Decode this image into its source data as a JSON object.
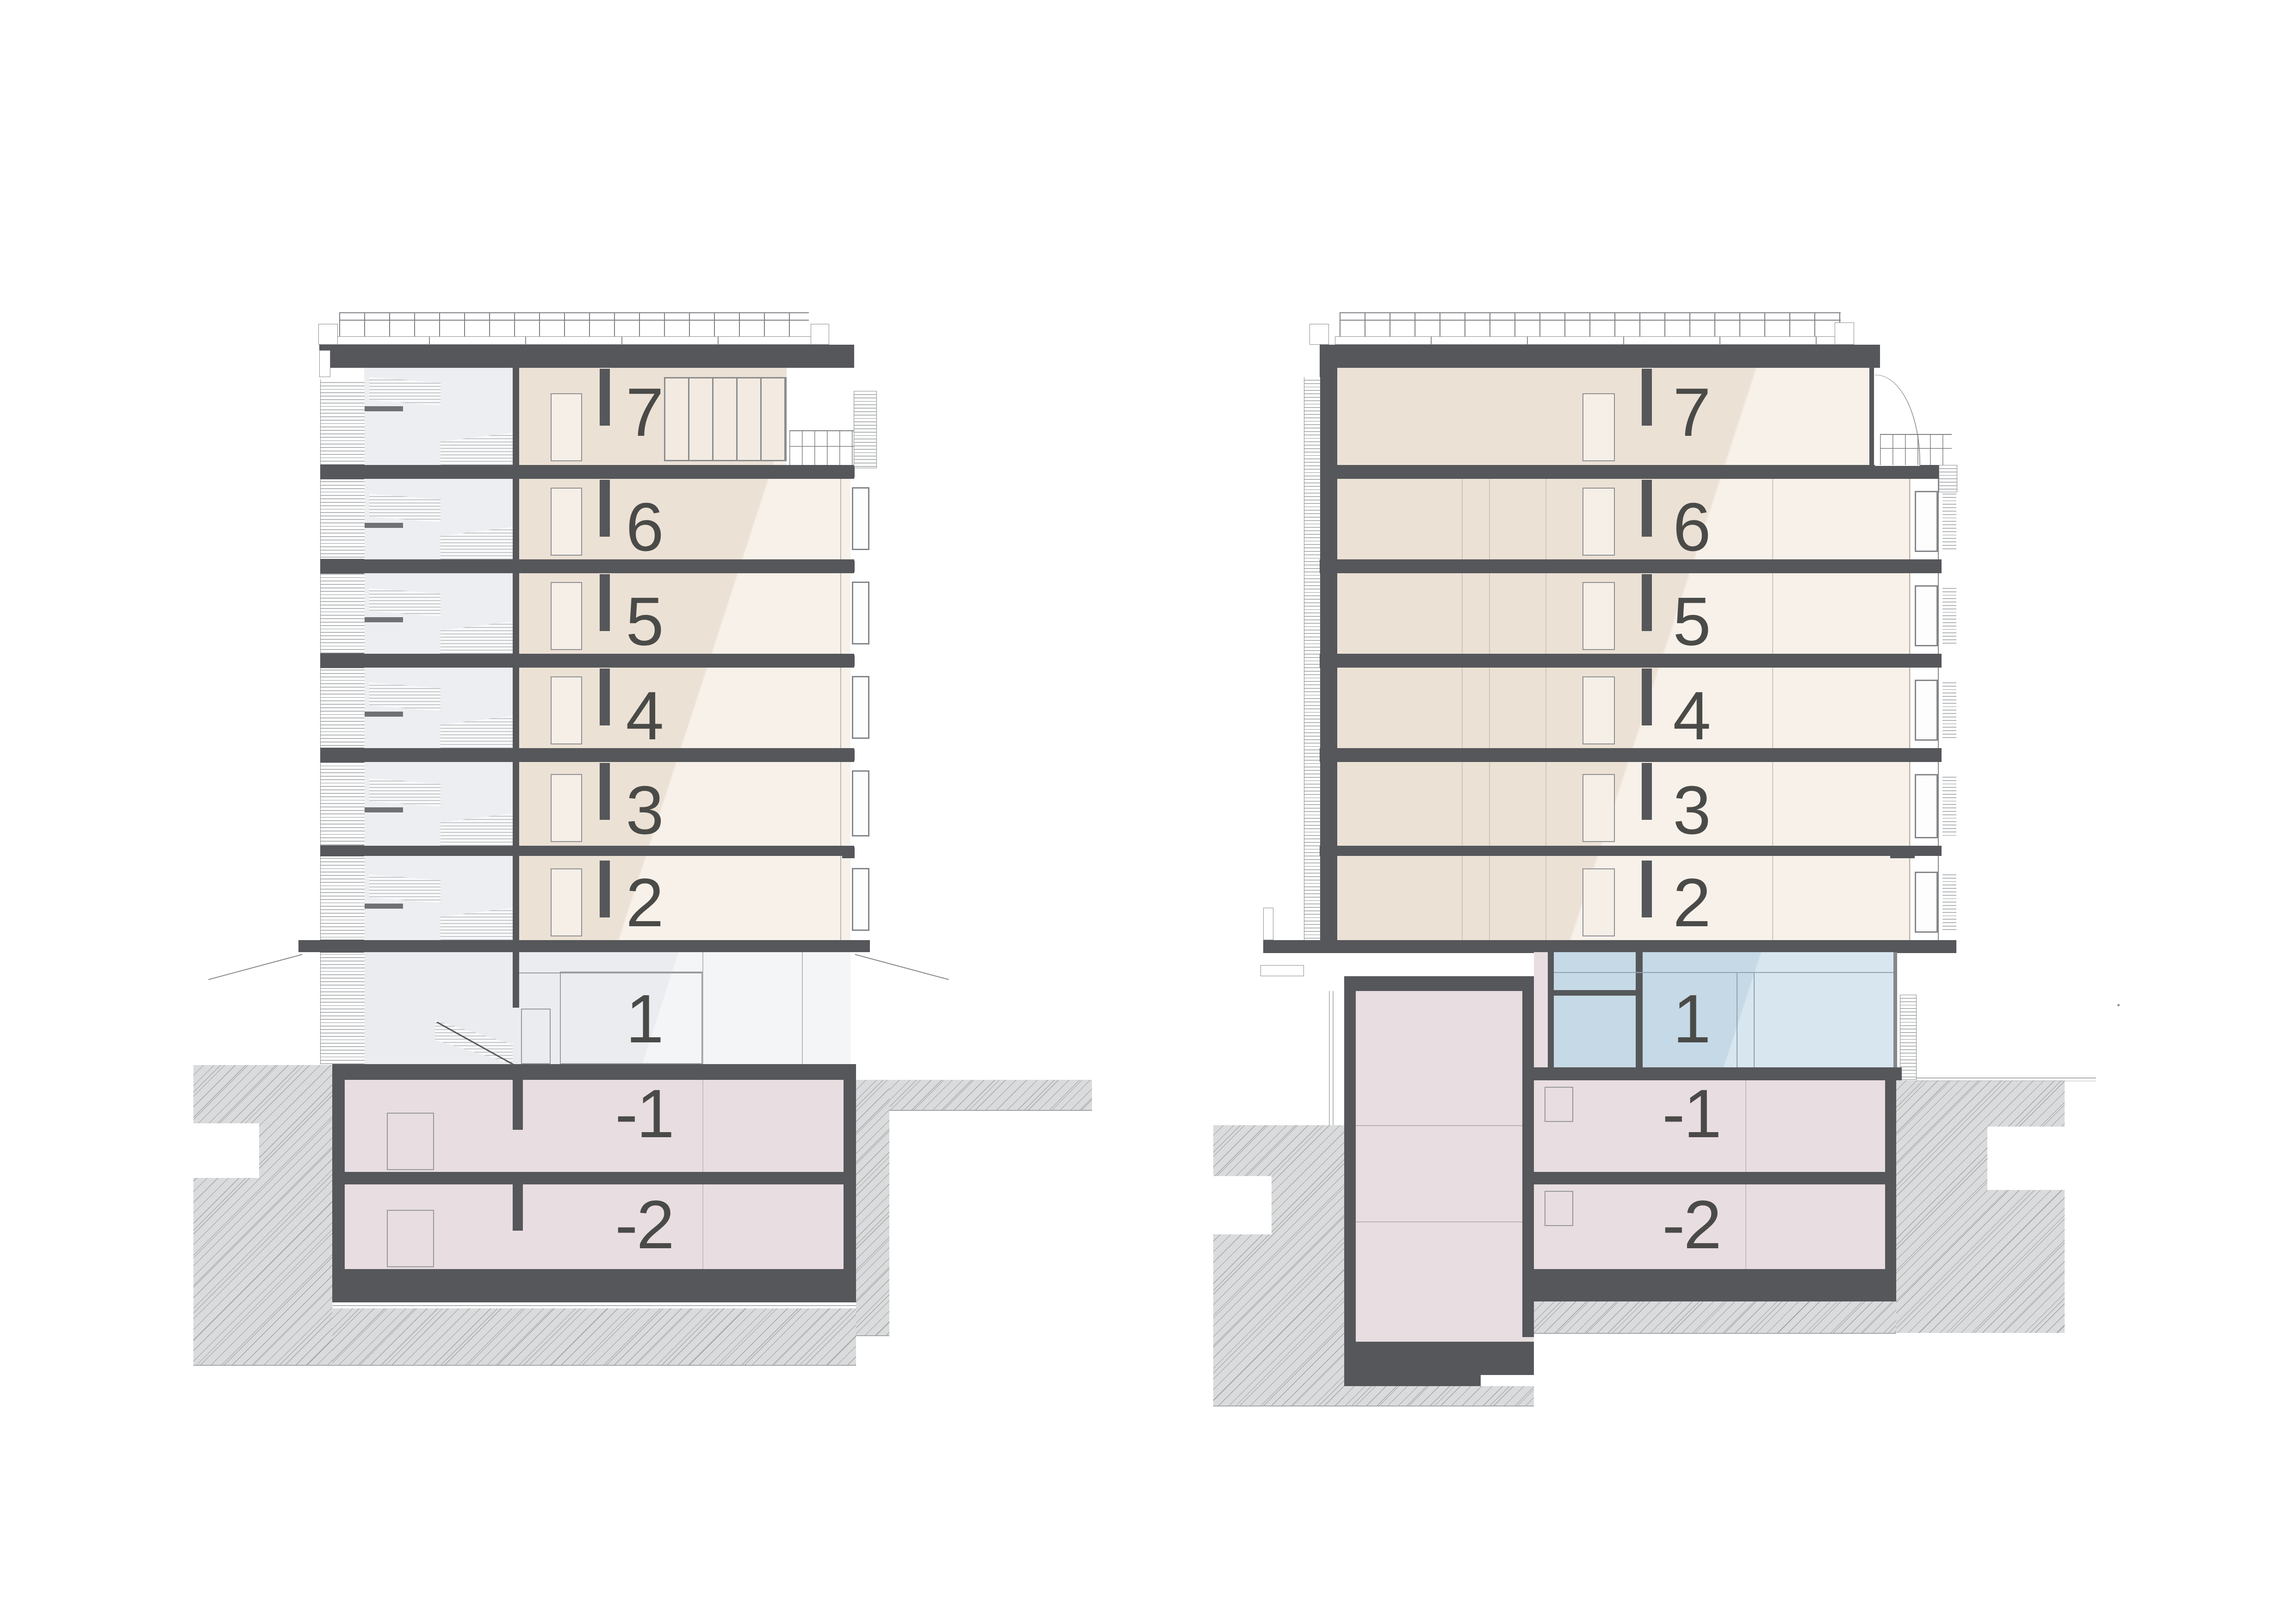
{
  "drawing_title": "residential building cross sections",
  "colors": {
    "apartment_fill": "#ece1d5",
    "apartment_highlight": "#f7f1ea",
    "ground_floor_fill": "#eaecef",
    "commercial_glass": "#c6d9e6",
    "basement_fill": "#e8dde0",
    "slab": "#55575a",
    "floor_label": "#4a4b48",
    "ground_hatch": "#dadbdc"
  },
  "sections": {
    "left": {
      "floors": {
        "f7": "7",
        "f6": "6",
        "f5": "5",
        "f4": "4",
        "f3": "3",
        "f2": "2",
        "f1": "1",
        "b1": "-1",
        "b2": "-2"
      }
    },
    "right": {
      "floors": {
        "f7": "7",
        "f6": "6",
        "f5": "5",
        "f4": "4",
        "f3": "3",
        "f2": "2",
        "f1": "1",
        "b1": "-1",
        "b2": "-2"
      }
    }
  }
}
